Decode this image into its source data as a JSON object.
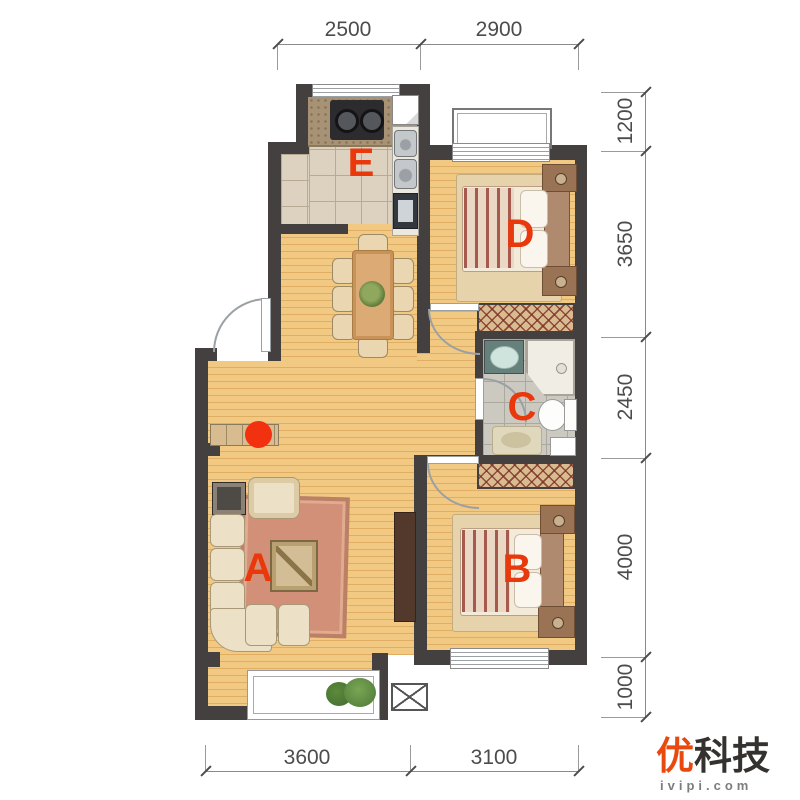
{
  "floorplan": {
    "room_labels": {
      "living_room": "A",
      "bedroom_small": "B",
      "bathroom": "C",
      "bedroom_large": "D",
      "kitchen": "E"
    },
    "dimensions": {
      "top": [
        "2500",
        "2900"
      ],
      "right": [
        "1200",
        "3650",
        "2450",
        "4000",
        "1000"
      ],
      "bottom": [
        "3600",
        "3100"
      ]
    },
    "colors": {
      "room_label": "#e8380c",
      "marker_dot": "#f23110",
      "wall": "#454040",
      "wood_floor": "#f2c983",
      "kitchen_tile": "#ddd2bf",
      "bathroom_tile": "#ccc9c1",
      "wardrobe": "#d9bb90",
      "dimension_text": "#4c4c4c"
    }
  },
  "watermark": {
    "brand_accent_char": "优",
    "brand_rest": "科技",
    "site": "ivipi.com"
  }
}
